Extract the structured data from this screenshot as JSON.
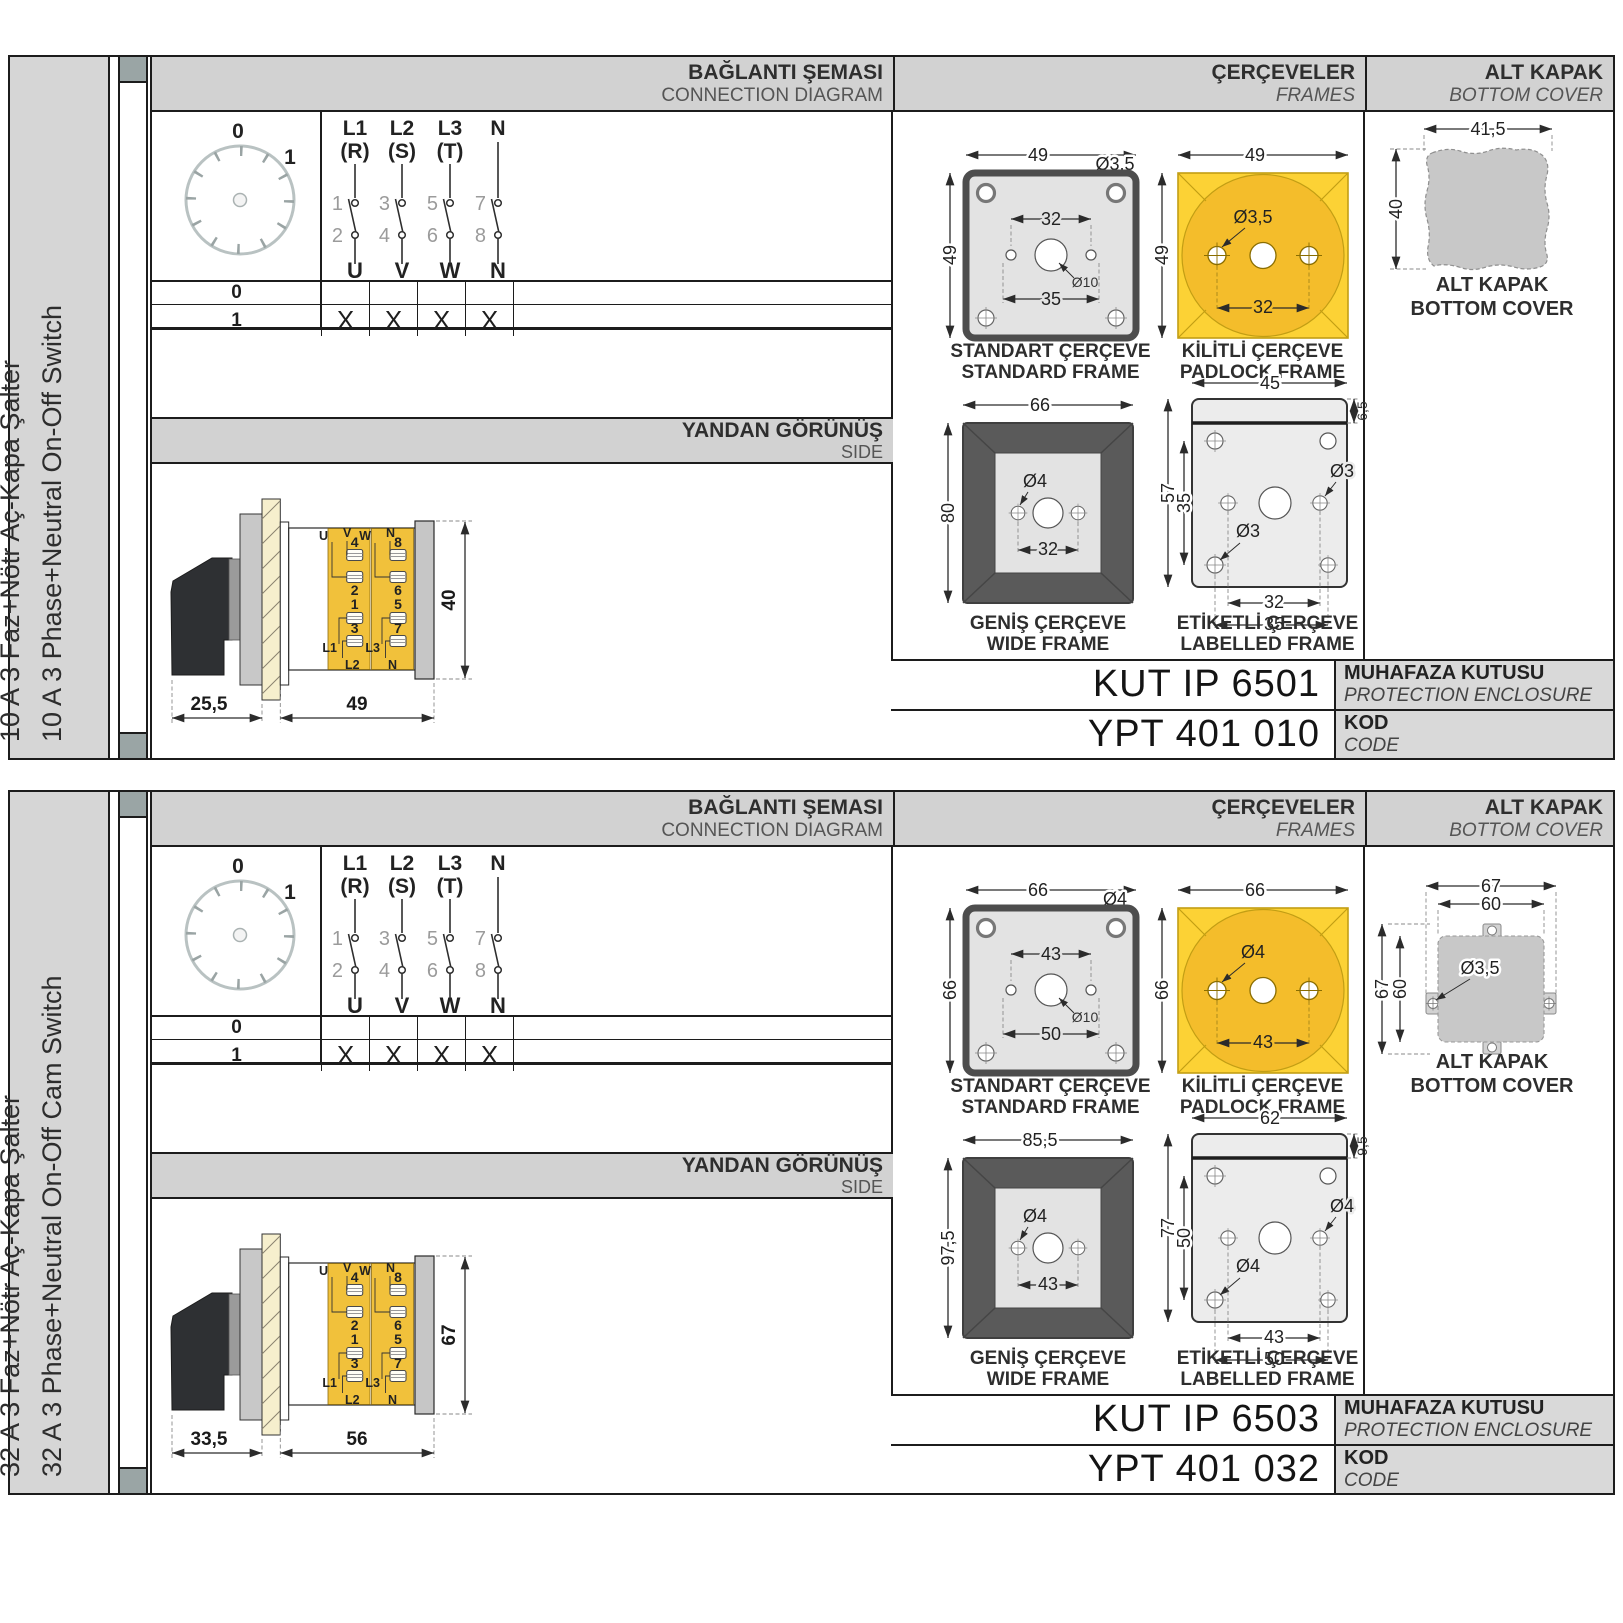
{
  "panels": [
    {
      "side_tr": "10 A 3 Faz+Nötr Aç-Kapa Şalter",
      "side_en": "10 A 3 Phase+Neutral On-Off Switch",
      "hdr": {
        "conn_tr": "BAĞLANTI ŞEMASI",
        "conn_en": "CONNECTION DIAGRAM",
        "frames_tr": "ÇERÇEVELER",
        "frames_en": "FRAMES",
        "cover_tr": "ALT KAPAK",
        "cover_en": "BOTTOM COVER"
      },
      "diagram": {
        "pos0": "0",
        "pos1": "1",
        "poles": [
          {
            "t1": "L1",
            "t2": "(R)",
            "n1": "1",
            "n2": "2",
            "b": "U",
            "lt": "50"
          },
          {
            "t1": "L2",
            "t2": "(S)",
            "n1": "3",
            "n2": "4",
            "b": "V",
            "lt": "50"
          },
          {
            "t1": "L3",
            "t2": "(T)",
            "n1": "5",
            "n2": "6",
            "b": "W",
            "lt": "50"
          },
          {
            "t1": "N",
            "t2": "",
            "n1": "7",
            "n2": "8",
            "b": "N",
            "lt": "28"
          }
        ],
        "rows": [
          {
            "label": "0",
            "m1": "",
            "m2": "",
            "m3": "",
            "m4": ""
          },
          {
            "label": "1",
            "m1": "X",
            "m2": "X",
            "m3": "X",
            "m4": "X"
          }
        ]
      },
      "side_view": {
        "tr": "YANDAN GÖRÜNÜŞ",
        "en": "SIDE",
        "d_front": "25,5",
        "d_body": "49",
        "d_height": "40",
        "u": "U",
        "v": "V",
        "w": "W",
        "n_top": "N",
        "t1": "1",
        "t2": "2",
        "t3": "3",
        "t4": "4",
        "t5": "5",
        "t6": "6",
        "t7": "7",
        "t8": "8",
        "l1": "L1",
        "l2": "L2",
        "l3": "L3",
        "n_bot": "N"
      },
      "frames": {
        "std": {
          "cap_tr": "STANDART ÇERÇEVE",
          "cap_en": "STANDARD FRAME",
          "w": "49",
          "h": "49",
          "hole": "Ø3,5",
          "span": "32",
          "center": "Ø10",
          "span2": "35"
        },
        "pad": {
          "cap_tr": "KİLİTLİ ÇERÇEVE",
          "cap_en": "PADLOCK FRAME",
          "w": "49",
          "h": "49",
          "hole": "Ø3,5",
          "span": "32"
        },
        "wide": {
          "cap_tr": "GENİŞ ÇERÇEVE",
          "cap_en": "WIDE FRAME",
          "w": "66",
          "h": "80",
          "hole": "Ø4",
          "span": "32"
        },
        "lab": {
          "cap_tr": "ETİKETLİ ÇERÇEVE",
          "cap_en": "LABELLED FRAME",
          "w": "45",
          "band": "6,5",
          "h": "57",
          "h2": "35",
          "hole1": "Ø3",
          "hole2": "Ø3",
          "span": "32",
          "span2": "35"
        }
      },
      "cover": {
        "variant": "blob",
        "cap_tr": "ALT KAPAK",
        "cap_en": "BOTTOM COVER",
        "w": "41,5",
        "h": "40"
      },
      "codes": {
        "enclosure": "KUT IP 6501",
        "enclosure_tr": "MUHAFAZA KUTUSU",
        "enclosure_en": "PROTECTION ENCLOSURE",
        "code": "YPT 401 010",
        "code_tr": "KOD",
        "code_en": "CODE"
      }
    },
    {
      "side_tr": "32 A 3 Faz+Nötr Aç-Kapa Şalter",
      "side_en": "32 A 3 Phase+Neutral On-Off Cam Switch",
      "hdr": {
        "conn_tr": "BAĞLANTI ŞEMASI",
        "conn_en": "CONNECTION DIAGRAM",
        "frames_tr": "ÇERÇEVELER",
        "frames_en": "FRAMES",
        "cover_tr": "ALT KAPAK",
        "cover_en": "BOTTOM COVER"
      },
      "diagram": {
        "pos0": "0",
        "pos1": "1",
        "poles": [
          {
            "t1": "L1",
            "t2": "(R)",
            "n1": "1",
            "n2": "2",
            "b": "U",
            "lt": "50"
          },
          {
            "t1": "L2",
            "t2": "(S)",
            "n1": "3",
            "n2": "4",
            "b": "V",
            "lt": "50"
          },
          {
            "t1": "L3",
            "t2": "(T)",
            "n1": "5",
            "n2": "6",
            "b": "W",
            "lt": "50"
          },
          {
            "t1": "N",
            "t2": "",
            "n1": "7",
            "n2": "8",
            "b": "N",
            "lt": "28"
          }
        ],
        "rows": [
          {
            "label": "0",
            "m1": "",
            "m2": "",
            "m3": "",
            "m4": ""
          },
          {
            "label": "1",
            "m1": "X",
            "m2": "X",
            "m3": "X",
            "m4": "X"
          }
        ]
      },
      "side_view": {
        "tr": "YANDAN GÖRÜNÜŞ",
        "en": "SIDE",
        "d_front": "33,5",
        "d_body": "56",
        "d_height": "67",
        "u": "U",
        "v": "V",
        "w": "W",
        "n_top": "N",
        "t1": "1",
        "t2": "2",
        "t3": "3",
        "t4": "4",
        "t5": "5",
        "t6": "6",
        "t7": "7",
        "t8": "8",
        "l1": "L1",
        "l2": "L2",
        "l3": "L3",
        "n_bot": "N"
      },
      "frames": {
        "std": {
          "cap_tr": "STANDART ÇERÇEVE",
          "cap_en": "STANDARD FRAME",
          "w": "66",
          "h": "66",
          "hole": "Ø4",
          "span": "43",
          "center": "Ø10",
          "span2": "50"
        },
        "pad": {
          "cap_tr": "KİLİTLİ ÇERÇEVE",
          "cap_en": "PADLOCK FRAME",
          "w": "66",
          "h": "66",
          "hole": "Ø4",
          "span": "43"
        },
        "wide": {
          "cap_tr": "GENİŞ ÇERÇEVE",
          "cap_en": "WIDE FRAME",
          "w": "85,5",
          "h": "97,5",
          "hole": "Ø4",
          "span": "43"
        },
        "lab": {
          "cap_tr": "ETİKETLİ ÇERÇEVE",
          "cap_en": "LABELLED FRAME",
          "w": "62",
          "band": "9,5",
          "h": "77",
          "h2": "50",
          "hole1": "Ø4",
          "hole2": "Ø4",
          "span": "43",
          "span2": "50"
        }
      },
      "cover": {
        "variant": "tabbed",
        "cap_tr": "ALT KAPAK",
        "cap_en": "BOTTOM COVER",
        "w_outer": "67",
        "w_inner": "60",
        "h_outer": "67",
        "h_inner": "60",
        "hole": "Ø3,5"
      },
      "codes": {
        "enclosure": "KUT IP 6503",
        "enclosure_tr": "MUHAFAZA KUTUSU",
        "enclosure_en": "PROTECTION ENCLOSURE",
        "code": "YPT 401 032",
        "code_tr": "KOD",
        "code_en": "CODE"
      }
    }
  ]
}
